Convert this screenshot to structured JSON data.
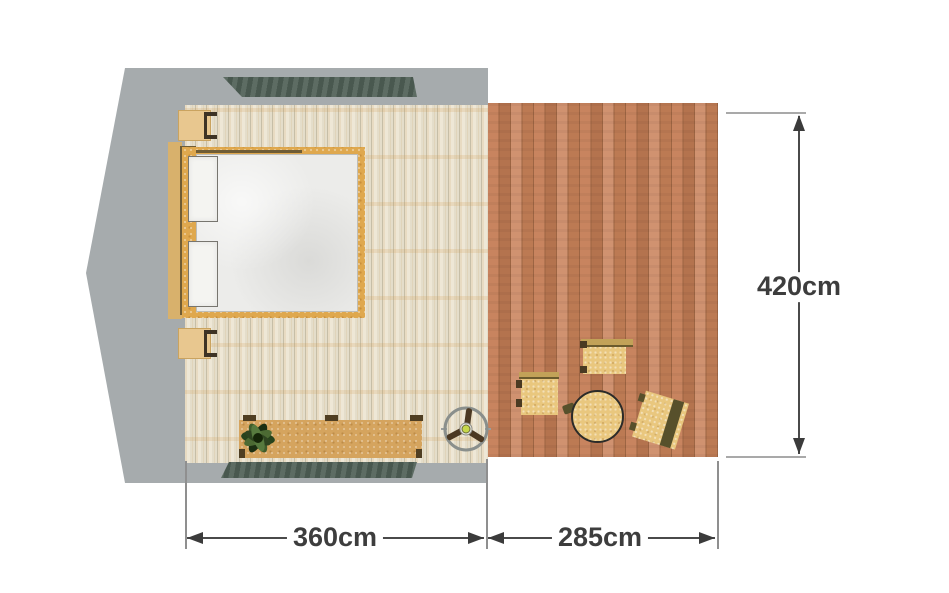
{
  "annotations": {
    "deck_height": "420cm",
    "bedroom_width": "360cm",
    "deck_width": "285cm"
  },
  "dimensions": {
    "unit": "cm",
    "bedroom_width_value": 360,
    "deck_width_value": 285,
    "deck_height_value": 420
  },
  "objects": {
    "roof_outline": "roof-outline",
    "vent_top": "slatted-vent",
    "vent_bottom": "slatted-vent",
    "bedroom_floor": "light-plank-floor",
    "deck_floor": "terracotta-deck-boards",
    "bed": "double-bed-with-two-pillows",
    "nightstand_top": "nightstand",
    "nightstand_bottom": "nightstand",
    "sideboard": "low-sideboard",
    "plant": "potted-plant",
    "ceiling_fan": "ceiling-fan",
    "stools": [
      "square-stool",
      "square-stool",
      "square-stool-rotated"
    ],
    "table": "round-table"
  },
  "colors": {
    "background": "#ffffff",
    "roof_gray": "#a6abad",
    "bedroom_floor": "#e9e2d0",
    "deck_wood": "#bc7a53",
    "bed_frame_gold": "#dfa84e",
    "headboard_shadow": "#6f5c35",
    "mattress_white": "#ececea",
    "furniture_sand": "#e9c77e",
    "sideboard_tan": "#d5a45e",
    "vent_green": "#52615a",
    "plant_green": "#2e4420",
    "dimension_text": "#3d3d3d"
  }
}
